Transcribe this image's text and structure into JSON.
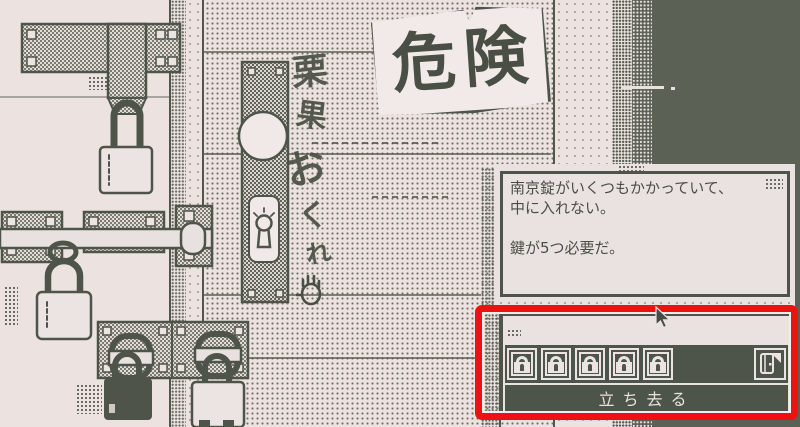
{
  "scene": {
    "danger_sign": "危険",
    "graffiti": [
      "栗",
      "果",
      "お",
      "く",
      "れ"
    ],
    "colors": {
      "ink": "#4f544a",
      "background": "#ece3e1",
      "dark_background": "#5c6156",
      "panel_dark": "#4d544a",
      "highlight_red": "#ee1111"
    }
  },
  "dialog": {
    "line1": "南京錠がいくつもかかっていて、",
    "line2": "中に入れない。",
    "line3": "鍵が5つ必要だ。"
  },
  "panel": {
    "lock_slots": [
      "padlock-icon",
      "padlock-icon",
      "padlock-icon",
      "padlock-icon",
      "padlock-icon"
    ],
    "door_icon": "exit-door-icon",
    "leave_button": "立ち去る"
  },
  "pointer": {
    "icon": "arrow-cursor"
  }
}
